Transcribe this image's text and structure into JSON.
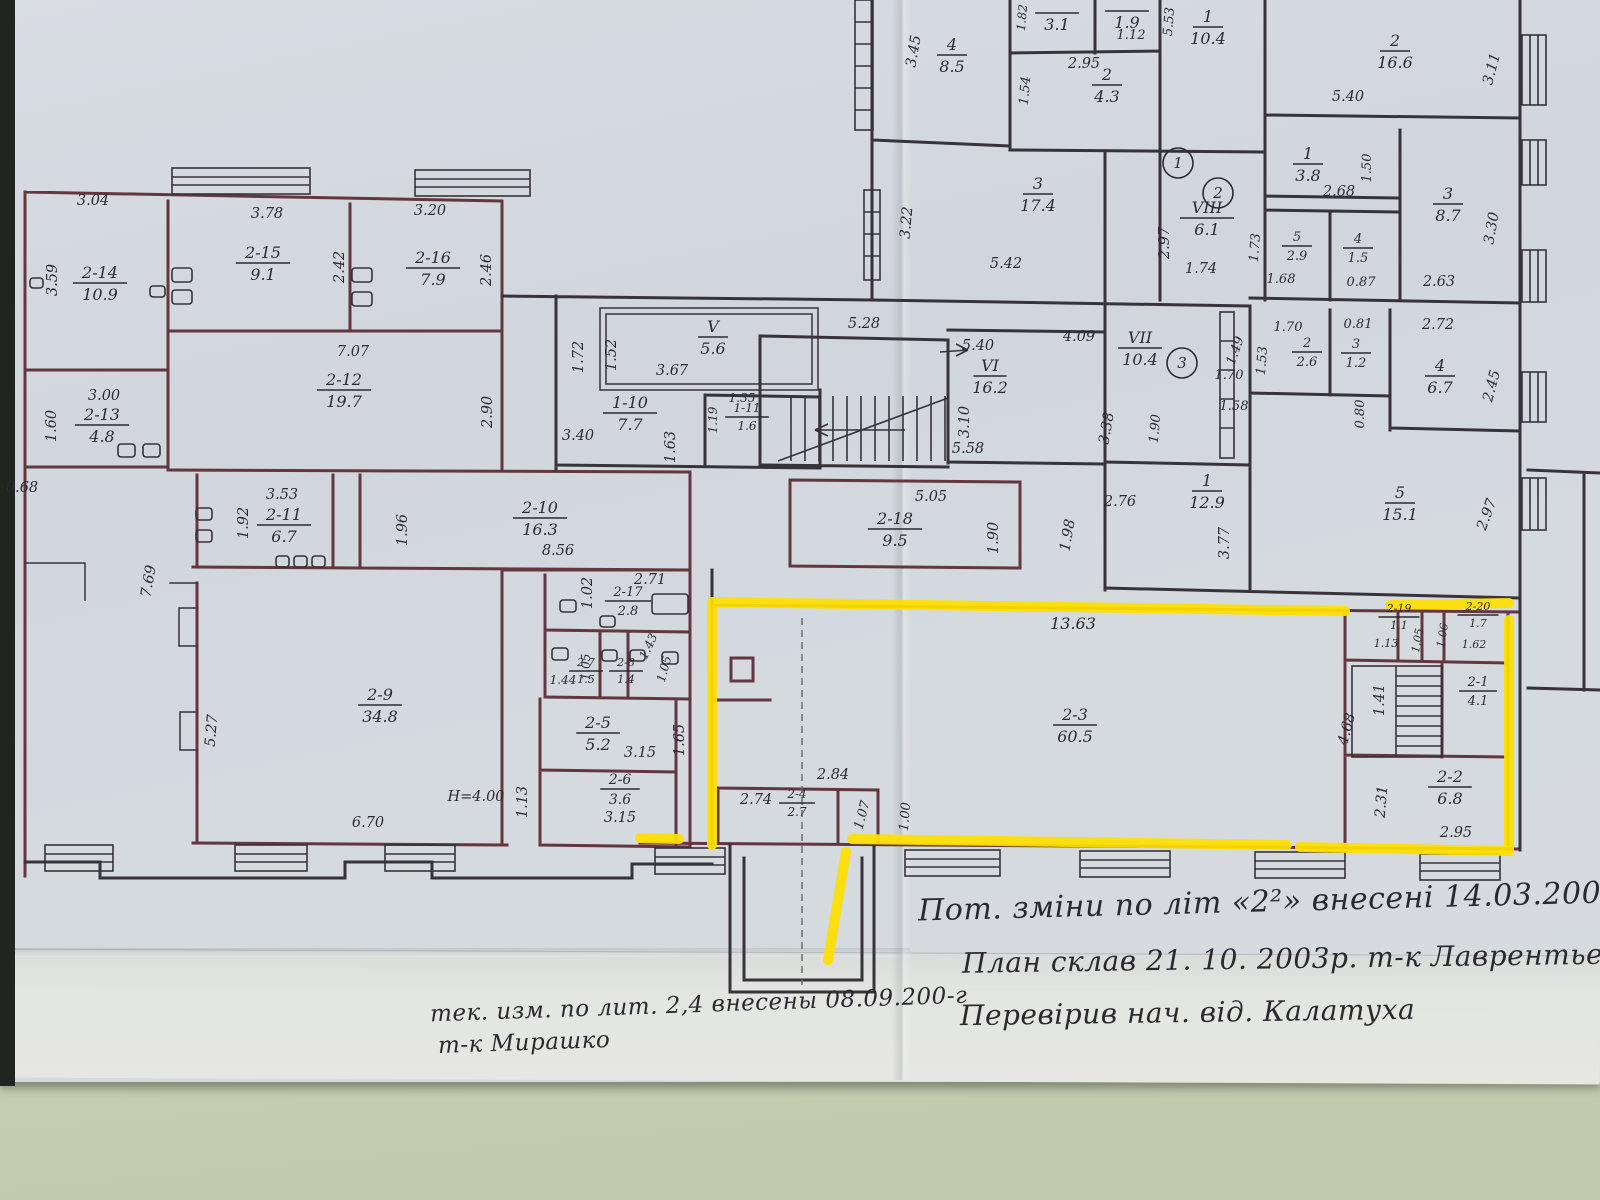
{
  "photo": {
    "paper_color": "#d3d9df",
    "lower_sheet_color": "#e2e5e1",
    "table_color": "#c9cfb2",
    "wall_ink_color": "#38323a",
    "unit_wall_color": "#643640",
    "handwriting_color": "#2d2a33",
    "highlight_color": "#ffdf00"
  },
  "plan": {
    "rooms": [
      {
        "id": "2-14",
        "area": "10.9",
        "x": 100,
        "y": 278
      },
      {
        "id": "2-15",
        "area": "9.1",
        "x": 263,
        "y": 258
      },
      {
        "id": "2-16",
        "area": "7.9",
        "x": 433,
        "y": 263
      },
      {
        "id": "2-12",
        "area": "19.7",
        "x": 344,
        "y": 385
      },
      {
        "id": "2-13",
        "area": "4.8",
        "x": 102,
        "y": 420
      },
      {
        "id": "2-11",
        "area": "6.7",
        "x": 284,
        "y": 520
      },
      {
        "id": "2-10",
        "area": "16.3",
        "x": 540,
        "y": 513
      },
      {
        "id": "2-9",
        "area": "34.8",
        "x": 380,
        "y": 700
      },
      {
        "id": "2-17",
        "area": "2.8",
        "x": 628,
        "y": 596,
        "s": 13
      },
      {
        "id": "2-7",
        "area": "1.5",
        "x": 586,
        "y": 666,
        "s": 11
      },
      {
        "id": "2-8",
        "area": "1.4",
        "x": 626,
        "y": 666,
        "s": 11
      },
      {
        "id": "2-5",
        "area": "5.2",
        "x": 598,
        "y": 728
      },
      {
        "id": "2-6",
        "area": "3.6",
        "x": 620,
        "y": 784,
        "s": 14
      },
      {
        "id": "2-18",
        "area": "9.5",
        "x": 895,
        "y": 524
      },
      {
        "id": "2-4",
        "area": "2.7",
        "x": 797,
        "y": 798,
        "s": 12
      },
      {
        "id": "2-3",
        "area": "60.5",
        "x": 1075,
        "y": 720
      },
      {
        "id": "2-19",
        "area": "1.1",
        "x": 1399,
        "y": 612,
        "s": 11
      },
      {
        "id": "2-20",
        "area": "1.7",
        "x": 1478,
        "y": 610,
        "s": 11
      },
      {
        "id": "2-1",
        "area": "4.1",
        "x": 1478,
        "y": 686,
        "s": 13
      },
      {
        "id": "2-2",
        "area": "6.8",
        "x": 1450,
        "y": 782
      },
      {
        "id": "V",
        "area": "5.6",
        "x": 713,
        "y": 332
      },
      {
        "id": "1-10",
        "area": "7.7",
        "x": 630,
        "y": 408
      },
      {
        "id": "1-11",
        "area": "1.6",
        "x": 747,
        "y": 412,
        "s": 12
      },
      {
        "id": "VI",
        "area": "16.2",
        "x": 990,
        "y": 371
      },
      {
        "id": "VII",
        "area": "10.4",
        "x": 1140,
        "y": 343
      },
      {
        "id": "VIII",
        "area": "6.1",
        "x": 1207,
        "y": 213
      },
      {
        "id": "4",
        "area": "8.5",
        "x": 952,
        "y": 50
      },
      {
        "id": "",
        "area": "3.1",
        "x": 1057,
        "y": 8
      },
      {
        "id": "",
        "area": "1.9",
        "x": 1127,
        "y": 6
      },
      {
        "id": "2",
        "area": "4.3",
        "x": 1107,
        "y": 80
      },
      {
        "id": "1",
        "area": "10.4",
        "x": 1208,
        "y": 22
      },
      {
        "id": "3",
        "area": "17.4",
        "x": 1038,
        "y": 189
      },
      {
        "id": "2",
        "area": "16.6",
        "x": 1395,
        "y": 46
      },
      {
        "id": "1",
        "area": "3.8",
        "x": 1308,
        "y": 159
      },
      {
        "id": "3",
        "area": "8.7",
        "x": 1448,
        "y": 199
      },
      {
        "id": "5",
        "area": "2.9",
        "x": 1297,
        "y": 241,
        "s": 13
      },
      {
        "id": "4",
        "area": "1.5",
        "x": 1358,
        "y": 243,
        "s": 13
      },
      {
        "id": "2",
        "area": "2.6",
        "x": 1307,
        "y": 347,
        "s": 13
      },
      {
        "id": "3",
        "area": "1.2",
        "x": 1356,
        "y": 348,
        "s": 13
      },
      {
        "id": "4",
        "area": "6.7",
        "x": 1440,
        "y": 371
      },
      {
        "id": "1",
        "area": "12.9",
        "x": 1207,
        "y": 486
      },
      {
        "id": "5",
        "area": "15.1",
        "x": 1400,
        "y": 498
      }
    ],
    "dims": [
      {
        "t": "3.04",
        "x": 93,
        "y": 205
      },
      {
        "t": "3.59",
        "x": 57,
        "y": 280,
        "r": -90
      },
      {
        "t": "3.78",
        "x": 267,
        "y": 218
      },
      {
        "t": "2.42",
        "x": 344,
        "y": 267,
        "r": -90
      },
      {
        "t": "3.20",
        "x": 430,
        "y": 215
      },
      {
        "t": "2.46",
        "x": 491,
        "y": 270,
        "r": -90
      },
      {
        "t": "7.07",
        "x": 353,
        "y": 356
      },
      {
        "t": "2.90",
        "x": 492,
        "y": 412,
        "r": -90
      },
      {
        "t": "3.00",
        "x": 104,
        "y": 400
      },
      {
        "t": "1.60",
        "x": 56,
        "y": 426,
        "r": -90
      },
      {
        "t": "0.68",
        "x": 22,
        "y": 492
      },
      {
        "t": "3.53",
        "x": 282,
        "y": 499
      },
      {
        "t": "1.92",
        "x": 248,
        "y": 523,
        "r": -90
      },
      {
        "t": "1.96",
        "x": 407,
        "y": 530,
        "r": -90
      },
      {
        "t": "7.69",
        "x": 153,
        "y": 582,
        "r": -80
      },
      {
        "t": "5.27",
        "x": 216,
        "y": 731,
        "r": -85
      },
      {
        "t": "6.70",
        "x": 368,
        "y": 827
      },
      {
        "t": "H=4.00",
        "x": 476,
        "y": 801
      },
      {
        "t": "1.13",
        "x": 527,
        "y": 802,
        "r": -90
      },
      {
        "t": "8.56",
        "x": 558,
        "y": 555
      },
      {
        "t": "1.02",
        "x": 592,
        "y": 593,
        "r": -90
      },
      {
        "t": "2.71",
        "x": 650,
        "y": 584
      },
      {
        "t": "1.44",
        "x": 563,
        "y": 684,
        "s": 12
      },
      {
        "t": "1.05",
        "x": 590,
        "y": 667,
        "r": -90,
        "s": 12
      },
      {
        "t": "1.43",
        "x": 652,
        "y": 648,
        "r": -65,
        "s": 12
      },
      {
        "t": "1.05",
        "x": 668,
        "y": 670,
        "r": -75,
        "s": 12
      },
      {
        "t": "3.15",
        "x": 640,
        "y": 757
      },
      {
        "t": "1.65",
        "x": 684,
        "y": 740,
        "r": -90
      },
      {
        "t": "3.15",
        "x": 620,
        "y": 822
      },
      {
        "t": "1.72",
        "x": 583,
        "y": 357,
        "r": -90
      },
      {
        "t": "1.52",
        "x": 616,
        "y": 355,
        "r": -90
      },
      {
        "t": "3.67",
        "x": 672,
        "y": 375
      },
      {
        "t": "3.40",
        "x": 578,
        "y": 440
      },
      {
        "t": "1.63",
        "x": 675,
        "y": 447,
        "r": -90
      },
      {
        "t": "1.35",
        "x": 742,
        "y": 402,
        "s": 12
      },
      {
        "t": "1.19",
        "x": 717,
        "y": 420,
        "r": -90,
        "s": 12
      },
      {
        "t": "5.28",
        "x": 864,
        "y": 328
      },
      {
        "t": "5.40",
        "x": 978,
        "y": 350
      },
      {
        "t": "3.10",
        "x": 969,
        "y": 422,
        "r": -90
      },
      {
        "t": "5.58",
        "x": 968,
        "y": 453
      },
      {
        "t": "5.05",
        "x": 931,
        "y": 501
      },
      {
        "t": "1.90",
        "x": 998,
        "y": 538,
        "r": -90
      },
      {
        "t": "1.98",
        "x": 1072,
        "y": 536,
        "r": -80
      },
      {
        "t": "2.76",
        "x": 1120,
        "y": 506
      },
      {
        "t": "3.77",
        "x": 1229,
        "y": 543,
        "r": -90
      },
      {
        "t": "3.45",
        "x": 918,
        "y": 52,
        "r": -80
      },
      {
        "t": "3.22",
        "x": 911,
        "y": 223,
        "r": -85
      },
      {
        "t": "5.42",
        "x": 1006,
        "y": 268
      },
      {
        "t": "1.82",
        "x": 1026,
        "y": 18,
        "r": -85,
        "s": 12
      },
      {
        "t": "1.12",
        "x": 1131,
        "y": 39,
        "s": 13
      },
      {
        "t": "2.95",
        "x": 1084,
        "y": 68
      },
      {
        "t": "1.54",
        "x": 1029,
        "y": 91,
        "r": -85,
        "s": 13
      },
      {
        "t": "5.53",
        "x": 1173,
        "y": 22,
        "r": -85,
        "s": 13
      },
      {
        "t": "2.97",
        "x": 1169,
        "y": 243,
        "r": -90
      },
      {
        "t": "1.74",
        "x": 1201,
        "y": 273
      },
      {
        "t": "5.40",
        "x": 1348,
        "y": 101
      },
      {
        "t": "3.11",
        "x": 1496,
        "y": 70,
        "r": -75
      },
      {
        "t": "2.68",
        "x": 1339,
        "y": 196
      },
      {
        "t": "1.50",
        "x": 1371,
        "y": 168,
        "r": -90,
        "s": 13
      },
      {
        "t": "3.30",
        "x": 1496,
        "y": 229,
        "r": -80
      },
      {
        "t": "1.73",
        "x": 1259,
        "y": 248,
        "r": -85,
        "s": 13
      },
      {
        "t": "1.68",
        "x": 1281,
        "y": 283,
        "s": 13
      },
      {
        "t": "0.87",
        "x": 1361,
        "y": 286,
        "s": 13
      },
      {
        "t": "2.63",
        "x": 1439,
        "y": 286
      },
      {
        "t": "1.70",
        "x": 1288,
        "y": 331,
        "s": 13
      },
      {
        "t": "0.81",
        "x": 1358,
        "y": 328,
        "s": 13
      },
      {
        "t": "2.72",
        "x": 1438,
        "y": 329
      },
      {
        "t": "1.49",
        "x": 1239,
        "y": 352,
        "r": -70,
        "s": 13
      },
      {
        "t": "1.53",
        "x": 1266,
        "y": 361,
        "r": -85,
        "s": 13
      },
      {
        "t": "2.45",
        "x": 1496,
        "y": 387,
        "r": -75
      },
      {
        "t": "0.80",
        "x": 1364,
        "y": 414,
        "r": -90,
        "s": 13
      },
      {
        "t": "4.09",
        "x": 1079,
        "y": 341
      },
      {
        "t": "1.70",
        "x": 1229,
        "y": 379,
        "s": 13
      },
      {
        "t": "1.58",
        "x": 1234,
        "y": 410,
        "s": 13
      },
      {
        "t": "1.90",
        "x": 1159,
        "y": 429,
        "r": -85,
        "s": 13
      },
      {
        "t": "3.38",
        "x": 1111,
        "y": 429,
        "r": -80
      },
      {
        "t": "2.97",
        "x": 1491,
        "y": 516,
        "r": -70
      },
      {
        "t": "13.63",
        "x": 1073,
        "y": 629,
        "s": 16
      },
      {
        "t": "2.74",
        "x": 756,
        "y": 804
      },
      {
        "t": "2.84",
        "x": 833,
        "y": 779
      },
      {
        "t": "1.00",
        "x": 909,
        "y": 817,
        "r": -85,
        "s": 13
      },
      {
        "t": "1.07",
        "x": 866,
        "y": 816,
        "r": -75,
        "s": 13
      },
      {
        "t": "1.13",
        "x": 1386,
        "y": 647,
        "s": 11
      },
      {
        "t": "1.62",
        "x": 1474,
        "y": 648,
        "s": 11
      },
      {
        "t": "1.06",
        "x": 1446,
        "y": 636,
        "r": -80,
        "s": 11
      },
      {
        "t": "1.05",
        "x": 1421,
        "y": 641,
        "r": -80,
        "s": 11
      },
      {
        "t": "1.41",
        "x": 1384,
        "y": 700,
        "r": -90
      },
      {
        "t": "4.68",
        "x": 1351,
        "y": 730,
        "r": -75
      },
      {
        "t": "2.31",
        "x": 1386,
        "y": 802,
        "r": -85
      },
      {
        "t": "2.95",
        "x": 1456,
        "y": 837
      }
    ],
    "circles": [
      {
        "t": "1",
        "x": 1178,
        "y": 163
      },
      {
        "t": "2",
        "x": 1218,
        "y": 193
      },
      {
        "t": "3",
        "x": 1182,
        "y": 363
      }
    ],
    "notes": [
      {
        "t": "Пот. зміни по літ «2²» внесені 14.03.2005р т-к Мат",
        "x": 918,
        "y": 882,
        "size": 30,
        "rot": -1.5
      },
      {
        "t": "План склав  21. 10. 2003р.  т-к Лаврентьева",
        "x": 962,
        "y": 942,
        "size": 28,
        "rot": -0.8
      },
      {
        "t": "Перевірив нач. від. Калатуха",
        "x": 960,
        "y": 996,
        "size": 28,
        "rot": -0.8
      },
      {
        "t": "тек. изм.  по лит. 2,4 внесены  08.09.200-г",
        "x": 430,
        "y": 992,
        "size": 23,
        "rot": -2
      },
      {
        "t": "т-к  Мирашко",
        "x": 438,
        "y": 1030,
        "size": 23,
        "rot": -2
      }
    ]
  }
}
